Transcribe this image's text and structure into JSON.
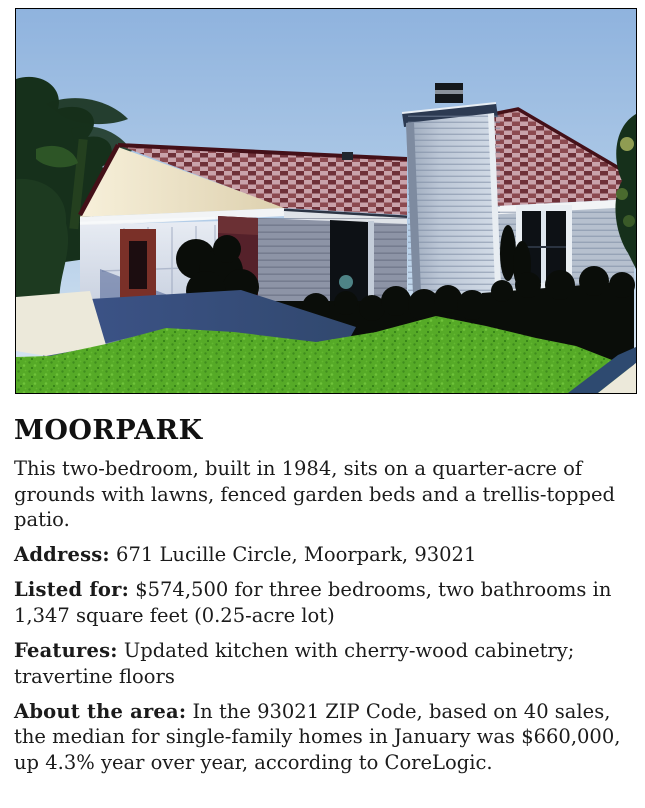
{
  "article": {
    "headline": "MOORPARK",
    "intro": "This two-bedroom, built in 1984, sits on a quarter-acre of grounds with lawns, fenced garden beds and a trellis-topped patio.",
    "details": [
      {
        "label": "Address:",
        "text": " 671 Lucille Circle, Moorpark, 93021"
      },
      {
        "label": "Listed for:",
        "text": " $574,500 for three bedrooms, two bathrooms in 1,347 square feet (0.25-acre lot)"
      },
      {
        "label": "Features:",
        "text": " Updated kitchen with cherry-wood cabinetry; travertine floors"
      },
      {
        "label": "About the area:",
        "text": " In the 93021 ZIP Code, based on 40 sales, the median for single-family homes in January was $660,000, up 4.3% year over year, according to CoreLogic."
      }
    ]
  },
  "photo": {
    "colors": {
      "headline": "#111111",
      "text": "#1b1b1b",
      "sky_top": "#8fb3de",
      "sky_bottom": "#dbe8f3",
      "roof_trim": "#441018",
      "gable_cream": "#f0e7cd",
      "fascia": "#f2f4f6",
      "garage_door": "#e9edf4",
      "maroon_wall": "#55212a",
      "wall_shadow": "#8d94a6",
      "chimney": "#bcc7d6",
      "chimney_cap": "#2c3a52",
      "window_dark": "#0d1115",
      "foliage": "#16301b",
      "shadow": "#0a0d09",
      "lawn": "#56aa27",
      "driveway": "#31486e",
      "concrete": "#ece9da"
    }
  }
}
